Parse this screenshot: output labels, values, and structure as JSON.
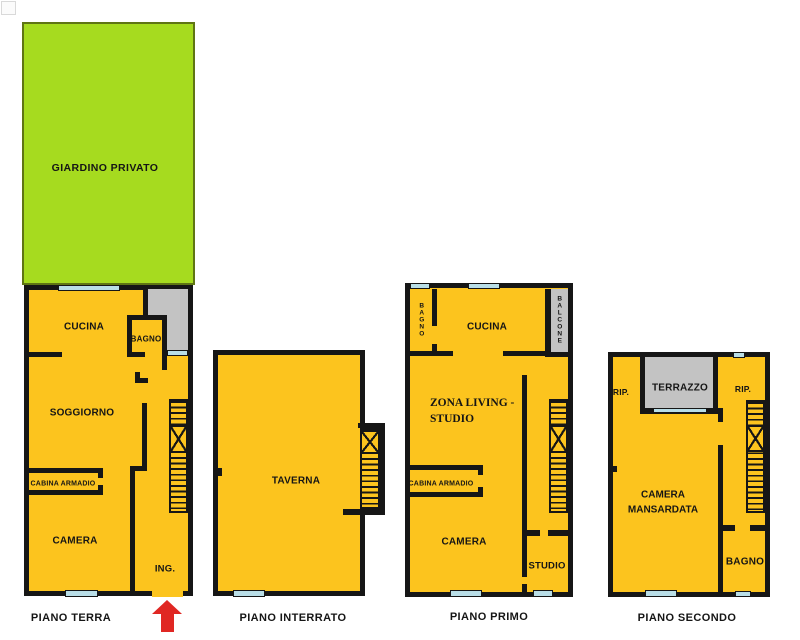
{
  "colors": {
    "floor": "#FCC41E",
    "garden": "#A6DB1F",
    "garden-border": "#5F7514",
    "terrace": "#C3C3C3",
    "window": "#B9DEE7",
    "wall": "#161616",
    "arrow": "#E02723"
  },
  "floors": [
    {
      "name": "PIANO TERRA",
      "rooms": {
        "giardino": "GIARDINO PRIVATO",
        "cucina": "CUCINA",
        "bagno": "BAGNO",
        "soggiorno": "SOGGIORNO",
        "cabina_armadio": "CABINA ARMADIO",
        "camera": "CAMERA",
        "ingresso": "ING."
      }
    },
    {
      "name": "PIANO INTERRATO",
      "rooms": {
        "taverna": "TAVERNA"
      }
    },
    {
      "name": "PIANO PRIMO",
      "rooms": {
        "bagno": "BAGNO",
        "cucina": "CUCINA",
        "balcone": "BALCONE",
        "zona_living_line1": "ZONA LIVING -",
        "zona_living_line2": "STUDIO",
        "cabina_armadio": "CABINA ARMADIO",
        "camera": "CAMERA",
        "studio": "STUDIO"
      }
    },
    {
      "name": "PIANO SECONDO",
      "rooms": {
        "rip_left": "RIP.",
        "terrazzo": "TERRAZZO",
        "rip_right": "RIP.",
        "camera_line1": "CAMERA",
        "camera_line2": "MANSARDATA",
        "bagno": "BAGNO"
      }
    }
  ]
}
